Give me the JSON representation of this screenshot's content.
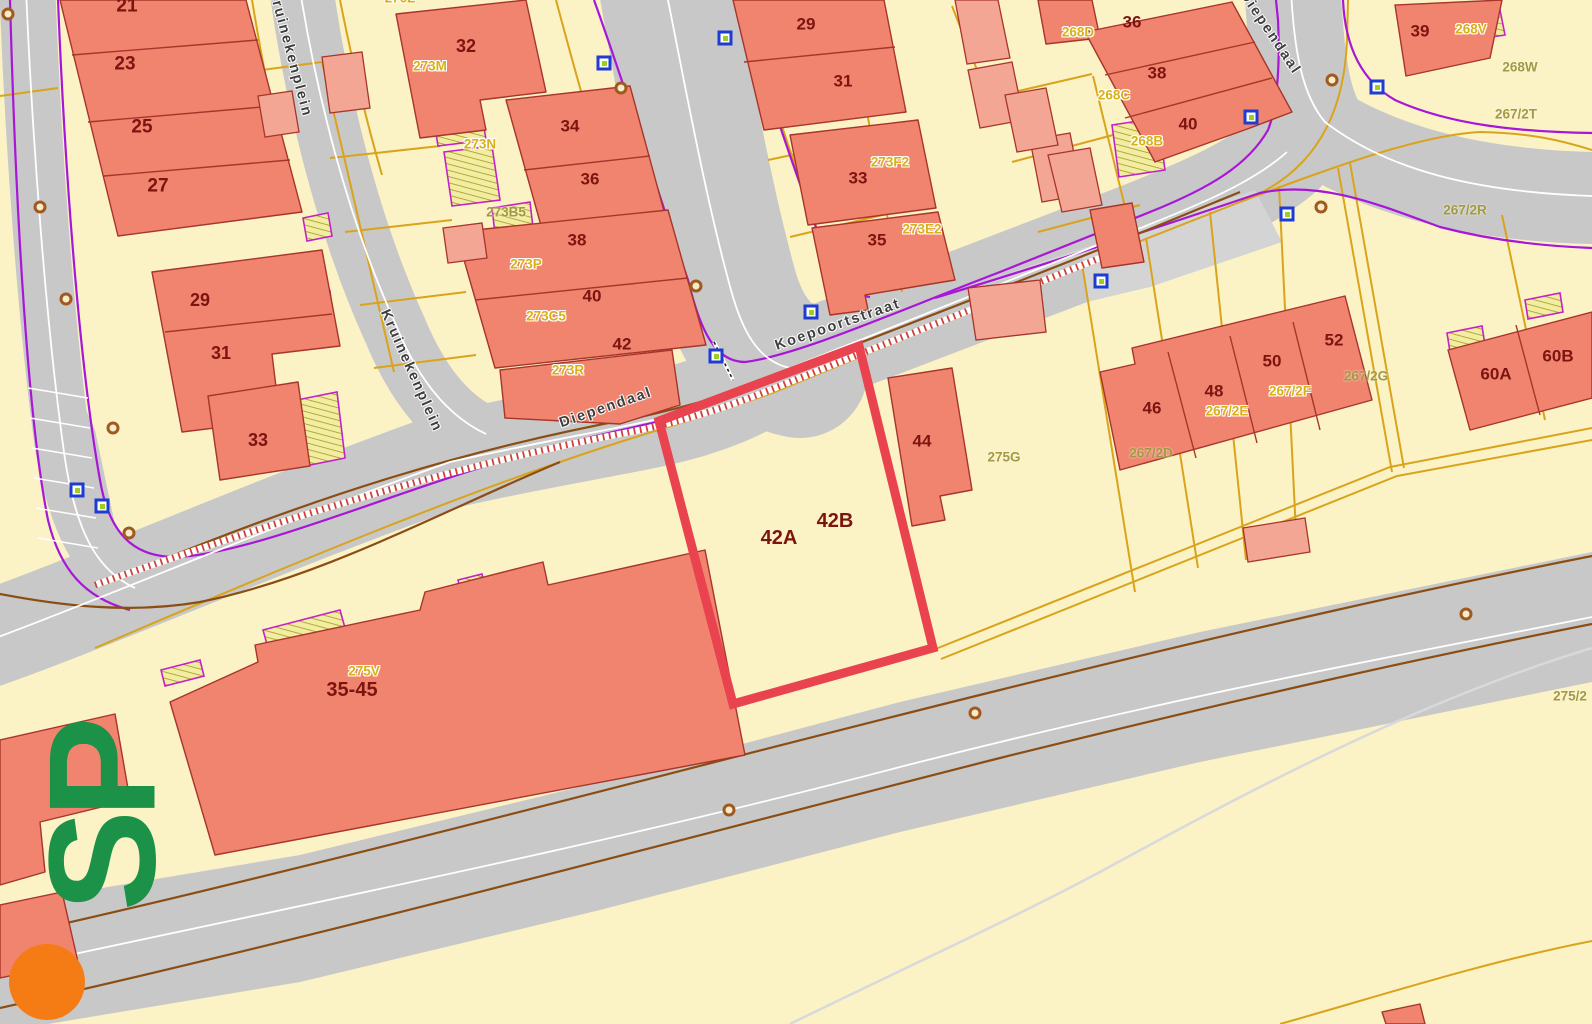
{
  "theme": {
    "bg": "#fbf2c6",
    "highlight-red": "#e8434e",
    "num": "#7c1410",
    "gold-label": "#d7b117",
    "olive-label": "#a39a3f",
    "logo-green": "#1b9247",
    "logo-orange": "#f57c14",
    "building-fill": "#f0846f",
    "building-light-fill": "#f4a694",
    "road-fill": "#c8c8c8"
  },
  "map": {
    "highlight": {
      "outline_points": "659,421 859,346 933,648 733,704",
      "parcel_house_numbers": [
        "42A",
        "42B"
      ]
    },
    "street_names": [
      {
        "t": "Koepoortstraat",
        "x": 838,
        "y": 325,
        "r": -19
      },
      {
        "t": "Diependaal",
        "x": 606,
        "y": 408,
        "r": -19
      },
      {
        "t": "Diependaal",
        "x": 1270,
        "y": 33,
        "r": 56
      },
      {
        "t": "Kruinekenplein",
        "x": 290,
        "y": 53,
        "r": 75
      },
      {
        "t": "Kruinekenplein",
        "x": 411,
        "y": 371,
        "r": 66
      }
    ],
    "building_numbers": [
      {
        "t": "21",
        "x": 127,
        "y": 6,
        "s": 19
      },
      {
        "t": "23",
        "x": 125,
        "y": 64,
        "s": 19
      },
      {
        "t": "25",
        "x": 142,
        "y": 127,
        "s": 19
      },
      {
        "t": "27",
        "x": 158,
        "y": 186,
        "s": 19
      },
      {
        "t": "29",
        "x": 200,
        "y": 300,
        "s": 18
      },
      {
        "t": "31",
        "x": 221,
        "y": 353,
        "s": 18
      },
      {
        "t": "33",
        "x": 258,
        "y": 440,
        "s": 18
      },
      {
        "t": "32",
        "x": 466,
        "y": 46,
        "s": 18
      },
      {
        "t": "34",
        "x": 570,
        "y": 126
      },
      {
        "t": "36",
        "x": 590,
        "y": 179
      },
      {
        "t": "38",
        "x": 577,
        "y": 240
      },
      {
        "t": "40",
        "x": 592,
        "y": 296
      },
      {
        "t": "42",
        "x": 622,
        "y": 344
      },
      {
        "t": "29",
        "x": 806,
        "y": 24
      },
      {
        "t": "31",
        "x": 843,
        "y": 81
      },
      {
        "t": "33",
        "x": 858,
        "y": 178
      },
      {
        "t": "35",
        "x": 877,
        "y": 240
      },
      {
        "t": "36",
        "x": 1132,
        "y": 22
      },
      {
        "t": "38",
        "x": 1157,
        "y": 73
      },
      {
        "t": "40",
        "x": 1188,
        "y": 124
      },
      {
        "t": "39",
        "x": 1420,
        "y": 31
      },
      {
        "t": "44",
        "x": 922,
        "y": 441
      },
      {
        "t": "46",
        "x": 1152,
        "y": 408
      },
      {
        "t": "48",
        "x": 1214,
        "y": 391
      },
      {
        "t": "50",
        "x": 1272,
        "y": 361
      },
      {
        "t": "52",
        "x": 1334,
        "y": 340
      },
      {
        "t": "60A",
        "x": 1496,
        "y": 374
      },
      {
        "t": "60B",
        "x": 1558,
        "y": 356
      },
      {
        "t": "42A",
        "x": 779,
        "y": 538,
        "s": 20
      },
      {
        "t": "42B",
        "x": 835,
        "y": 521,
        "s": 20
      },
      {
        "t": "35-45",
        "x": 352,
        "y": 690,
        "s": 20
      }
    ],
    "parcel_labels_gold": [
      {
        "t": "276Z",
        "x": 400,
        "y": -2
      },
      {
        "t": "273M",
        "x": 430,
        "y": 66
      },
      {
        "t": "273N",
        "x": 480,
        "y": 144
      },
      {
        "t": "273P",
        "x": 526,
        "y": 264
      },
      {
        "t": "273C5",
        "x": 546,
        "y": 316
      },
      {
        "t": "273R",
        "x": 568,
        "y": 370
      },
      {
        "t": "273F2",
        "x": 890,
        "y": 162
      },
      {
        "t": "273E2",
        "x": 922,
        "y": 229
      },
      {
        "t": "268D",
        "x": 1078,
        "y": 32
      },
      {
        "t": "268C",
        "x": 1114,
        "y": 95
      },
      {
        "t": "268B",
        "x": 1147,
        "y": 141
      },
      {
        "t": "268V",
        "x": 1471,
        "y": 29
      },
      {
        "t": "267/2F",
        "x": 1290,
        "y": 391
      },
      {
        "t": "267/2E",
        "x": 1227,
        "y": 411
      },
      {
        "t": "275V",
        "x": 364,
        "y": 671
      }
    ],
    "parcel_labels_olive": [
      {
        "t": "273B5",
        "x": 506,
        "y": 212
      },
      {
        "t": "268W",
        "x": 1520,
        "y": 67
      },
      {
        "t": "267/2T",
        "x": 1516,
        "y": 114
      },
      {
        "t": "267/2R",
        "x": 1465,
        "y": 210
      },
      {
        "t": "267/2G",
        "x": 1366,
        "y": 376
      },
      {
        "t": "267/2D",
        "x": 1151,
        "y": 453
      },
      {
        "t": "275G",
        "x": 1004,
        "y": 457
      },
      {
        "t": "275/2",
        "x": 1570,
        "y": 696
      }
    ],
    "markers": {
      "blue": [
        {
          "x": 604,
          "y": 63
        },
        {
          "x": 725,
          "y": 38
        },
        {
          "x": 811,
          "y": 312
        },
        {
          "x": 716,
          "y": 356
        },
        {
          "x": 1101,
          "y": 281
        },
        {
          "x": 1251,
          "y": 117
        },
        {
          "x": 1287,
          "y": 214
        },
        {
          "x": 77,
          "y": 490
        },
        {
          "x": 102,
          "y": 506
        },
        {
          "x": 1377,
          "y": 87
        }
      ],
      "brown": [
        {
          "x": 8,
          "y": 14
        },
        {
          "x": 40,
          "y": 207
        },
        {
          "x": 66,
          "y": 299
        },
        {
          "x": 113,
          "y": 428
        },
        {
          "x": 129,
          "y": 533
        },
        {
          "x": 621,
          "y": 88
        },
        {
          "x": 696,
          "y": 286
        },
        {
          "x": 1332,
          "y": 80
        },
        {
          "x": 1321,
          "y": 207
        },
        {
          "x": 729,
          "y": 810
        },
        {
          "x": 975,
          "y": 713
        },
        {
          "x": 1466,
          "y": 614
        }
      ]
    },
    "logo": {
      "text": "SP",
      "dot_x": 47,
      "dot_y": 982,
      "text_x": 103,
      "text_y": 818
    }
  }
}
